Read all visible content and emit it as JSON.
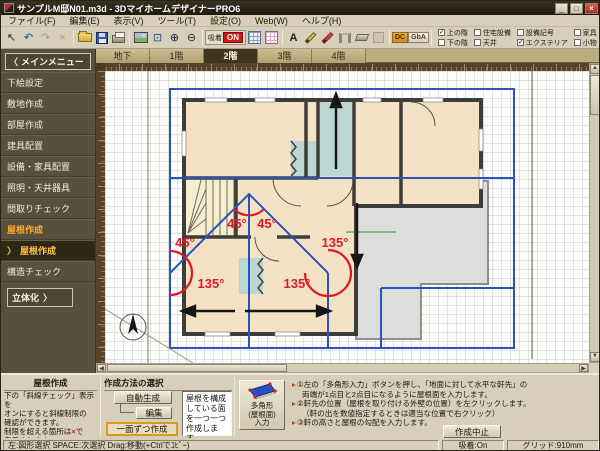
{
  "window": {
    "title": "サンプルM邸N01.m3d - 3DマイホームデザイナーPRO6",
    "minimize": "_",
    "maximize": "□",
    "close": "×"
  },
  "menu": {
    "items": [
      "ファイル(F)",
      "編集(E)",
      "表示(V)",
      "ツール(T)",
      "設定(O)",
      "Web(W)",
      "ヘルプ(H)"
    ]
  },
  "toolbar": {
    "select": "↖",
    "undo": "↶",
    "redo": "↷",
    "delete": "×",
    "fit": "⊡",
    "zoom_in": "⊕",
    "zoom_out": "⊖",
    "snap_label": "吸着",
    "snap_on": "ON",
    "text_tool": "A",
    "dc": "DC",
    "gba": "GbA",
    "checks": [
      {
        "label": "上の階",
        "mark": "✓"
      },
      {
        "label": "下の階",
        "mark": ""
      },
      {
        "label": "住宅設備",
        "mark": ""
      },
      {
        "label": "天井",
        "mark": ""
      },
      {
        "label": "設備記号",
        "mark": ""
      },
      {
        "label": "エクステリア",
        "mark": "✓"
      },
      {
        "label": "家具",
        "mark": ""
      },
      {
        "label": "小物",
        "mark": ""
      },
      {
        "label": "文字",
        "mark": "✓"
      },
      {
        "label": "付箋",
        "mark": "✓"
      }
    ]
  },
  "sidebar": {
    "back_arrow": "〈",
    "header": "メインメニュー",
    "items": [
      "下絵設定",
      "敷地作成",
      "部屋作成",
      "建具配置",
      "設備・家具配置",
      "照明・天井器具",
      "間取りチェック",
      "屋根作成"
    ],
    "sub_marker": "〉",
    "sub_item": "屋根作成",
    "item_last": "構造チェック",
    "solidify": "立体化",
    "solidify_arrow": "〉"
  },
  "tabs": {
    "items": [
      "地下",
      "1階",
      "2階",
      "3階",
      "4階"
    ],
    "active": "2階"
  },
  "canvas": {
    "angles": [
      "45°",
      "45°",
      "45°",
      "135°",
      "135°",
      "135°"
    ]
  },
  "roof_panel": {
    "title": "屋根作成",
    "line1": "下の「斜線チェック」表示を",
    "line2": "オンにすると斜線制限の",
    "line3": "確認ができます。",
    "line4a": "制限を超える箇所は",
    "line4x": "×",
    "line4b": "で",
    "line5": "表示されます。",
    "check_label": "斜線チェック",
    "check_mark": "✓"
  },
  "method_panel": {
    "title": "作成方法の選択",
    "auto_button": "自動生成",
    "edit_button": "編集",
    "one_button": "一面ずつ作成",
    "description": "屋根を構成している面を一つ一つ作成します。"
  },
  "tool_panel": {
    "polygon_l1": "多角形",
    "polygon_l2": "(屋根面)",
    "polygon_l3": "入力",
    "bullet": "▸",
    "step1a": "①左の「多角形入力」ボタンを押し、「地面に対して水平な軒先」の",
    "step1b": "両端が1点目と2点目になるように屋根面を入力します。",
    "step2a": "②軒先の位置（屋根を取り付ける外壁の位置）を左クリックします。",
    "step2b": "（軒の出を数値指定するときは適当な位置で右クリック）",
    "step3": "③軒の高さと屋根の勾配を入力します。",
    "cancel_button": "作成中止"
  },
  "status": {
    "left": "左:図形選択 SPACE:次選択 Drag:移動(+Ctrlでｺﾋﾟｰ)",
    "snap": "吸着:On",
    "grid": "グリッド:910mm"
  }
}
